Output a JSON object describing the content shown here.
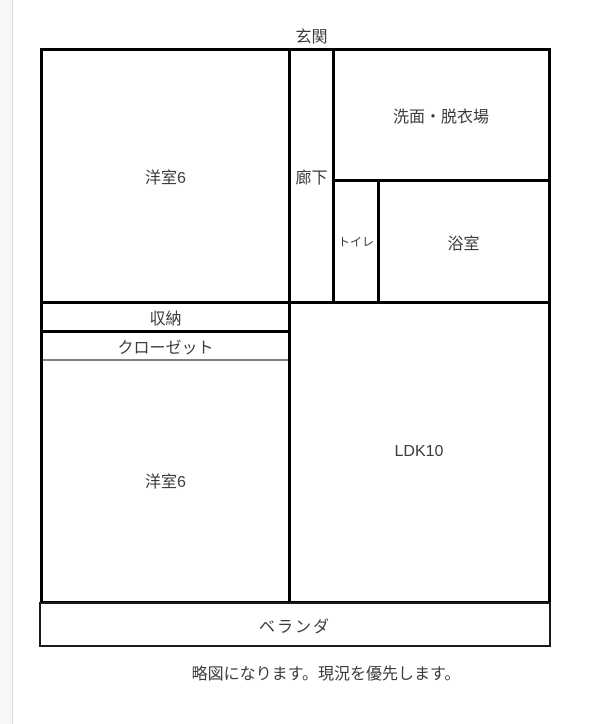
{
  "colors": {
    "wall": "#000000",
    "label_text": "#3b3b43",
    "closet_door_line": "#808080",
    "page_edge_strip": "#f7f7f7",
    "background": "#ffffff"
  },
  "floorplan": {
    "entrance_label": "玄関",
    "rooms": {
      "western_top": "洋室6",
      "corridor": "廊下",
      "washroom": "洗面・脱衣場",
      "toilet": "トイレ",
      "bathroom": "浴室",
      "storage": "収納",
      "closet": "クローゼット",
      "western_bottom": "洋室6",
      "ldk": "LDK10",
      "veranda": "ベランダ"
    },
    "caption": "略図になります。現況を優先します。"
  }
}
